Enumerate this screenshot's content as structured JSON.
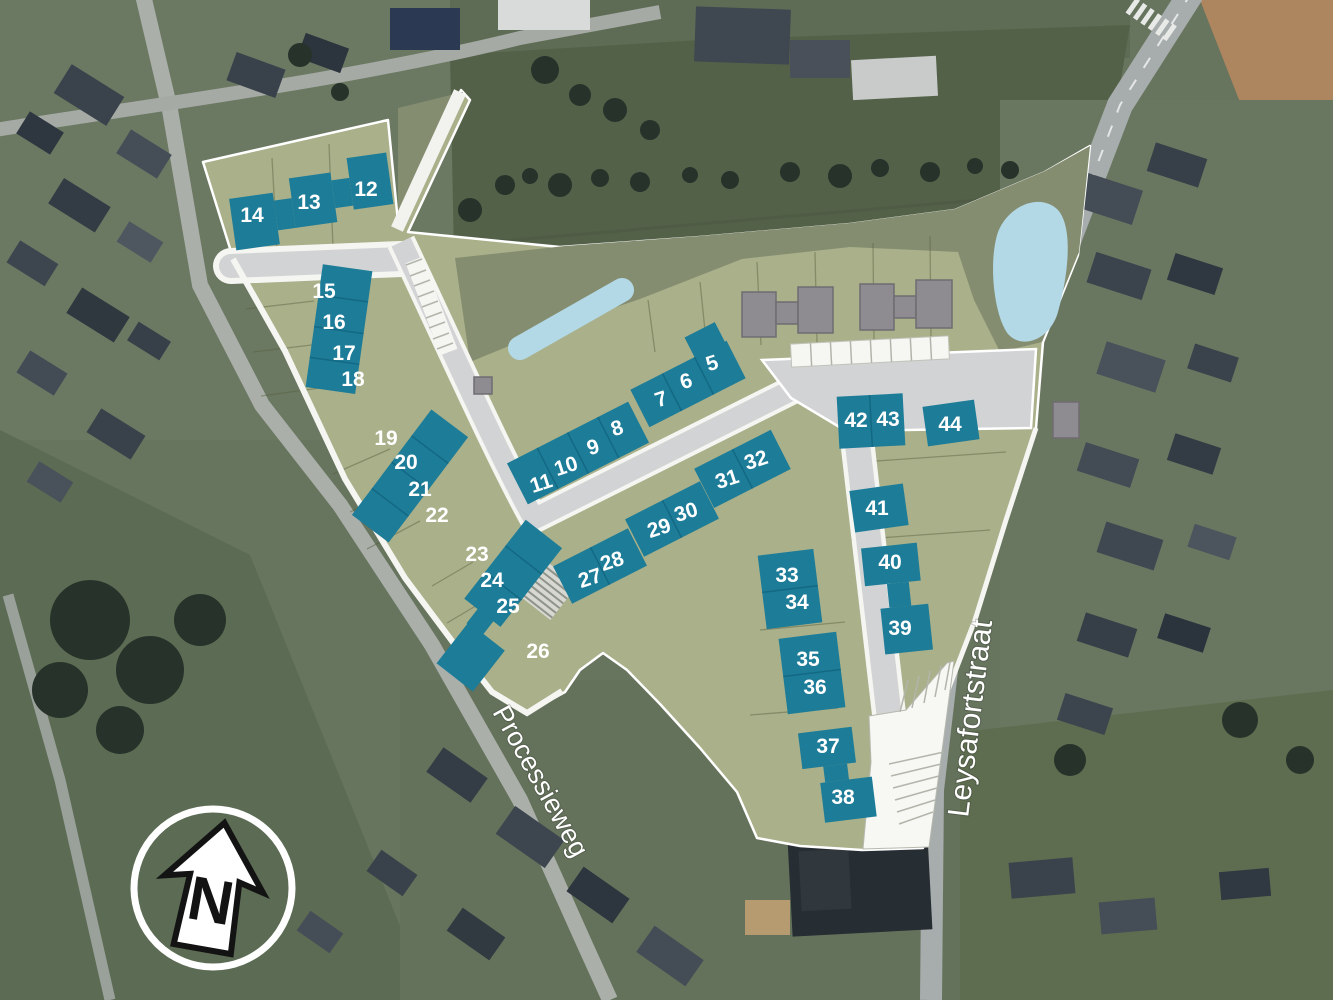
{
  "map": {
    "type": "residential-development-site-plan-overlay-on-aerial-photo",
    "north_indicator": "N",
    "street_labels": {
      "processieweg": "Processieweg",
      "leysafortstraat": "Leysafortstraat"
    },
    "colors": {
      "lot": "#1d7c98",
      "overlay_light": "#a9b08a",
      "overlay_dark": "#858d71",
      "water": "#b3d9e6",
      "road": "#d2d3d4",
      "existing_building": "#8e8c90",
      "number_text": "#ffffff"
    },
    "lots": [
      {
        "n": "5",
        "x": 712,
        "y": 363,
        "r": -18
      },
      {
        "n": "6",
        "x": 686,
        "y": 381,
        "r": -18
      },
      {
        "n": "7",
        "x": 661,
        "y": 399,
        "r": -18
      },
      {
        "n": "8",
        "x": 617,
        "y": 428,
        "r": -18
      },
      {
        "n": "9",
        "x": 593,
        "y": 447,
        "r": -18
      },
      {
        "n": "10",
        "x": 566,
        "y": 466,
        "r": -18
      },
      {
        "n": "11",
        "x": 541,
        "y": 483,
        "r": -18
      },
      {
        "n": "12",
        "x": 366,
        "y": 189,
        "r": 0
      },
      {
        "n": "13",
        "x": 309,
        "y": 202,
        "r": 0
      },
      {
        "n": "14",
        "x": 252,
        "y": 215,
        "r": 0
      },
      {
        "n": "15",
        "x": 324,
        "y": 291,
        "r": 0
      },
      {
        "n": "16",
        "x": 334,
        "y": 322,
        "r": 0
      },
      {
        "n": "17",
        "x": 344,
        "y": 353,
        "r": 0
      },
      {
        "n": "18",
        "x": 353,
        "y": 379,
        "r": 0
      },
      {
        "n": "19",
        "x": 386,
        "y": 438,
        "r": 0
      },
      {
        "n": "20",
        "x": 406,
        "y": 462,
        "r": 0
      },
      {
        "n": "21",
        "x": 420,
        "y": 489,
        "r": 0
      },
      {
        "n": "22",
        "x": 437,
        "y": 515,
        "r": 0
      },
      {
        "n": "23",
        "x": 477,
        "y": 554,
        "r": 0
      },
      {
        "n": "24",
        "x": 492,
        "y": 580,
        "r": 0
      },
      {
        "n": "25",
        "x": 508,
        "y": 606,
        "r": 0
      },
      {
        "n": "26",
        "x": 538,
        "y": 651,
        "r": 0
      },
      {
        "n": "27",
        "x": 590,
        "y": 578,
        "r": -18
      },
      {
        "n": "28",
        "x": 612,
        "y": 561,
        "r": -18
      },
      {
        "n": "29",
        "x": 659,
        "y": 528,
        "r": -18
      },
      {
        "n": "30",
        "x": 686,
        "y": 512,
        "r": -18
      },
      {
        "n": "31",
        "x": 727,
        "y": 479,
        "r": -18
      },
      {
        "n": "32",
        "x": 756,
        "y": 460,
        "r": -18
      },
      {
        "n": "33",
        "x": 787,
        "y": 575,
        "r": 0
      },
      {
        "n": "34",
        "x": 797,
        "y": 602,
        "r": 0
      },
      {
        "n": "35",
        "x": 808,
        "y": 659,
        "r": 0
      },
      {
        "n": "36",
        "x": 815,
        "y": 687,
        "r": 0
      },
      {
        "n": "37",
        "x": 828,
        "y": 746,
        "r": 0
      },
      {
        "n": "38",
        "x": 843,
        "y": 797,
        "r": 0
      },
      {
        "n": "39",
        "x": 900,
        "y": 628,
        "r": 0
      },
      {
        "n": "40",
        "x": 890,
        "y": 562,
        "r": 0
      },
      {
        "n": "41",
        "x": 877,
        "y": 508,
        "r": 0
      },
      {
        "n": "42",
        "x": 856,
        "y": 420,
        "r": 0
      },
      {
        "n": "43",
        "x": 888,
        "y": 419,
        "r": 0
      },
      {
        "n": "44",
        "x": 950,
        "y": 424,
        "r": 0
      }
    ]
  }
}
